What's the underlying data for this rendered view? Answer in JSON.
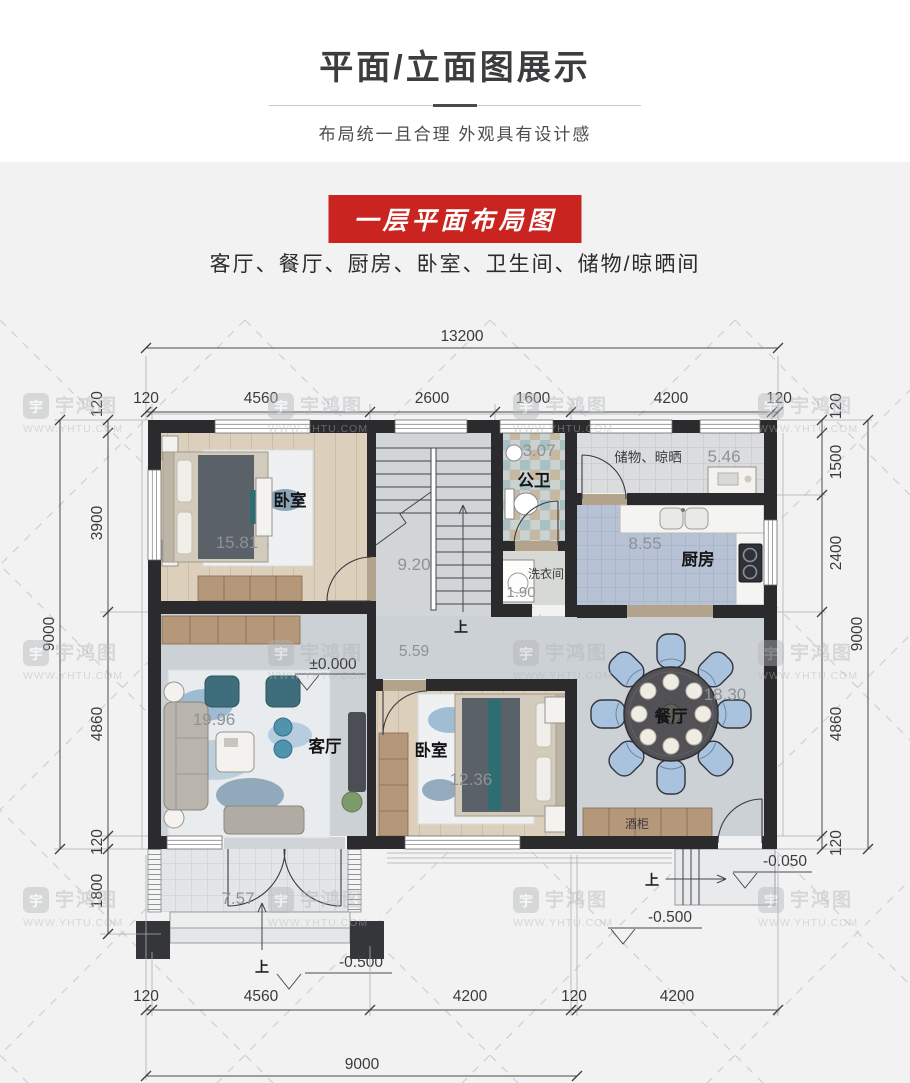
{
  "header": {
    "title": "平面/立面图展示",
    "subtitle": "布局统一且合理  外观具有设计感"
  },
  "section": {
    "banner": "一层平面布局图",
    "room_list": "客厅、餐厅、厨房、卧室、卫生间、储物/晾晒间"
  },
  "watermark": {
    "brand": "宇鸿图",
    "site": "WWW.YHTU.COM"
  },
  "colors": {
    "banner_red": "#c9241f",
    "wall": "#2b2b2d",
    "kitchen_tile": "#b7c3d5",
    "wood": "#b5977a",
    "sofa_teal": "#3e6e7b",
    "chair_blue": "#a9c3de"
  },
  "dims": {
    "top": {
      "overall": "13200",
      "segments": [
        "120",
        "4560",
        "2600",
        "1600",
        "4200",
        "120"
      ]
    },
    "left": {
      "overall": "9000",
      "segments": [
        "120",
        "3900",
        "4860",
        "120"
      ],
      "porch": "1800"
    },
    "right": {
      "overall": "9000",
      "segments": [
        "120",
        "1500",
        "2400",
        "4860",
        "120"
      ]
    },
    "bottom": {
      "overall": "9000",
      "segments": [
        "120",
        "4560",
        "4200",
        "120",
        "4200"
      ]
    }
  },
  "rooms": {
    "bedroom1": {
      "name": "卧室",
      "area": "15.81"
    },
    "stairs": {
      "area": "9.20"
    },
    "bath": {
      "name": "公卫",
      "area": "3.07"
    },
    "laundry": {
      "name": "洗衣间",
      "area": "1.90"
    },
    "storage": {
      "name": "储物、晾晒",
      "area": "5.46"
    },
    "kitchen": {
      "name": "厨房",
      "area": "8.55"
    },
    "living": {
      "name": "客厅",
      "area": "19.96"
    },
    "hall": {
      "area": "5.59"
    },
    "bedroom2": {
      "name": "卧室",
      "area": "12.36"
    },
    "dining": {
      "name": "餐厅",
      "area": "18.30"
    },
    "porch": {
      "area": "7.57"
    },
    "wine_cabinet": {
      "name": "酒柜"
    }
  },
  "levels": {
    "zero": "±0.000",
    "entry": "-0.050",
    "ground": "-0.500"
  },
  "marks": {
    "up": "上"
  }
}
